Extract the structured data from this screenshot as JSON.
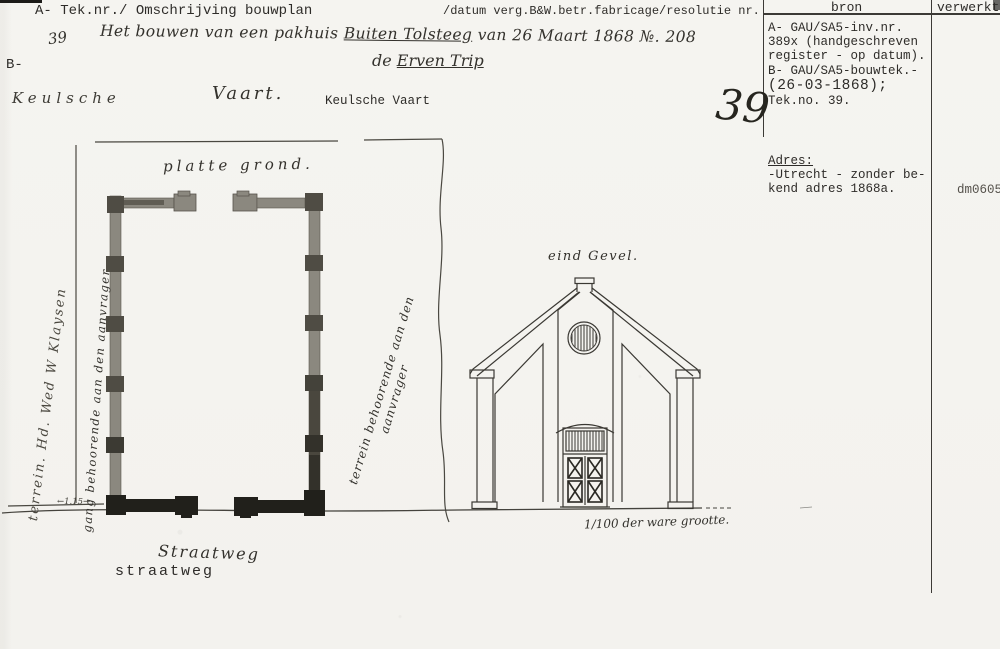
{
  "header": {
    "col_a_label": "A- Tek.nr./ Omschrijving bouwplan",
    "col_datum_label": "/datum verg.B&W.betr.fabricage/resolutie nr.",
    "b_label": "B-",
    "entry_no_small": "39",
    "title_part1": "Het bouwen van een pakhuis ",
    "title_part2_underlined": "Buiten Tolsteeg",
    "title_part3": " van 26 Maart 1868 №. 208",
    "title_line2_part1": "de ",
    "title_line2_part2_underlined": "Erven Trip"
  },
  "bron_panel": {
    "bron_header": "bron",
    "verwerkt_header": "verwerkt",
    "big_number": "39",
    "source_lines": [
      "A- GAU/SA5-inv.nr.",
      "389x (handgeschreven",
      "register - op datum).",
      "B- GAU/SA5-bouwtek.-",
      "(26-03-1868);",
      "Tek.no. 39."
    ],
    "adres_label": "Adres:",
    "adres_line1": "-Utrecht - zonder be-",
    "adres_line2": "kend adres 1868a.",
    "verwerkt_value": "dm0605"
  },
  "canal_labels": {
    "handwritten_keulsche": "Keulsche",
    "handwritten_vaart": "Vaart.",
    "typed": "Keulsche Vaart"
  },
  "street_labels": {
    "handwritten": "Straatweg",
    "typed": "straatweg"
  },
  "drawing": {
    "plan_label": "platte grond.",
    "elevation_label": "eind Gevel.",
    "scale_note": "1/100 der ware grootte.",
    "dimension_note": "←1.15→",
    "annotation_left_outer": "terrein. Hd. Wed W Klaysen",
    "annotation_gang": "gang behoorende aan den aanvrager",
    "annotation_terrein_line1": "terrein behoorende aan den",
    "annotation_terrein_line2": "aanvrager",
    "colors": {
      "ink": "#3a3833",
      "wall_light": "#8b887f",
      "wall_mid": "#4f4c44",
      "wall_dark": "#21201b",
      "paper": "#f5f4f0"
    }
  }
}
